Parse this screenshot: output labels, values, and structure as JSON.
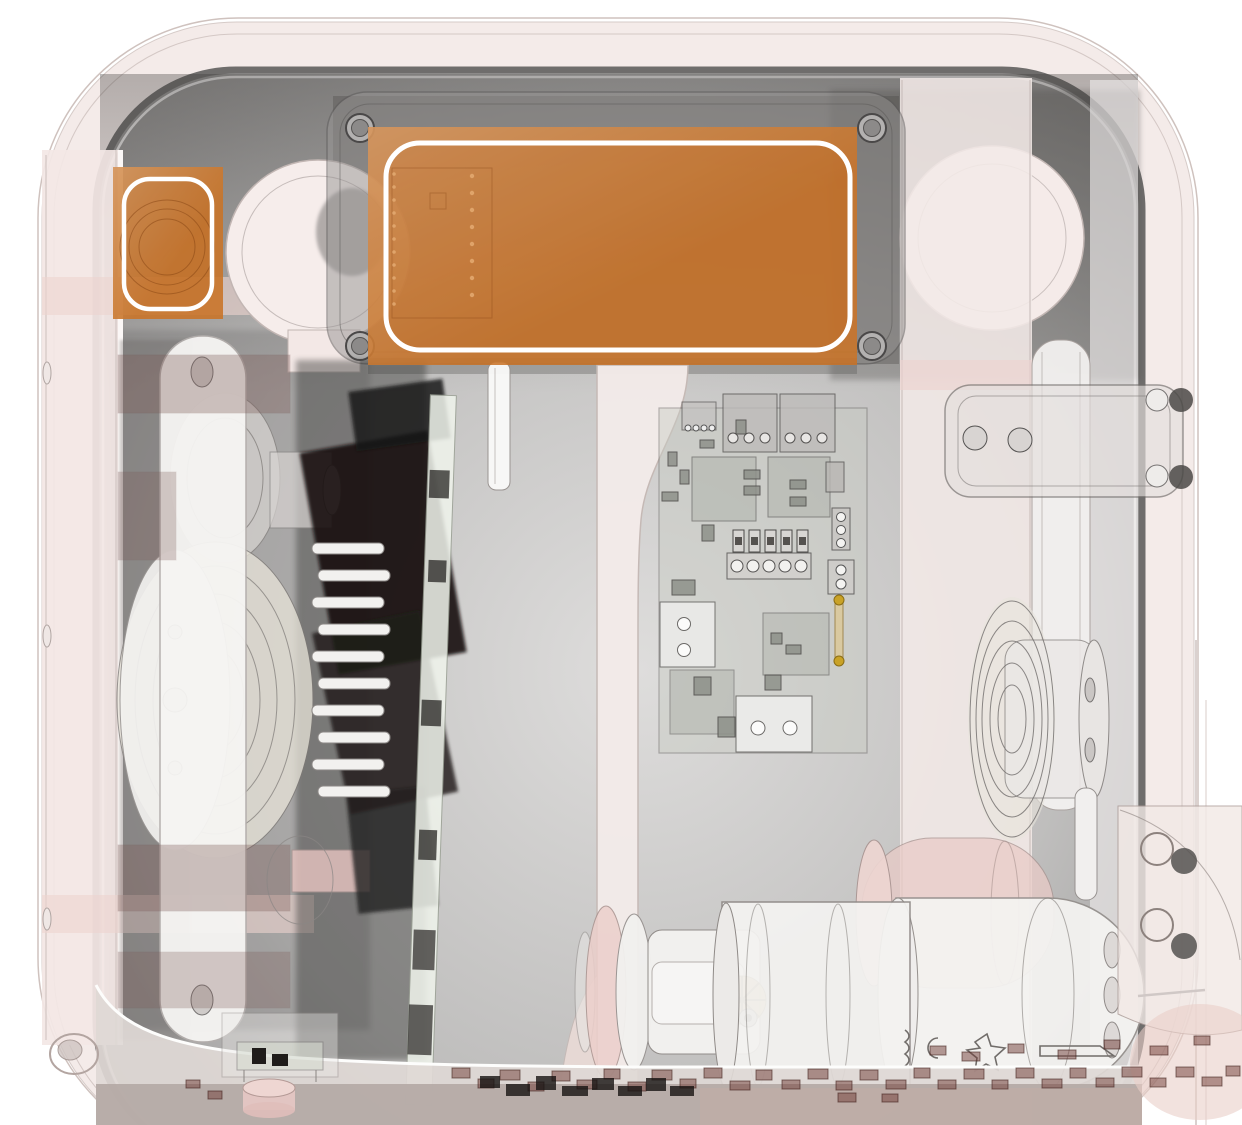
{
  "view": {
    "type": "cad-xray-render",
    "description": "Transparent x-ray CAD rendering of a device interior (speaker driver, PCBs, belt pulleys, gear motors) with two orange highlight hotspots",
    "width_px": 1242,
    "height_px": 1125
  },
  "colors": {
    "highlight_orange": "#c97429",
    "highlight_orange_deep": "#b9651f",
    "highlight_outline": "#ffffff",
    "shell_pink": "#f4ebe9",
    "shell_line": "#c9bcb8",
    "interior_light": "#d8d7d6",
    "interior_dark": "#8f8d8c",
    "inner_ring": "#6f6d6c",
    "pink_accent": "#ecd3cf",
    "ivory": "#e9e5da",
    "clamp_maroon": "#7d5a56",
    "smd_brown": "#703c35",
    "gear_tan": "#cdb27f",
    "base_band": "#b4a9a5"
  },
  "hotspots": {
    "large_highlight": {
      "shape": "rounded-rectangle",
      "color": "#c97429",
      "outline": "#ffffff"
    },
    "small_highlight": {
      "shape": "rounded-rectangle",
      "color": "#c97429",
      "outline": "#ffffff"
    }
  }
}
